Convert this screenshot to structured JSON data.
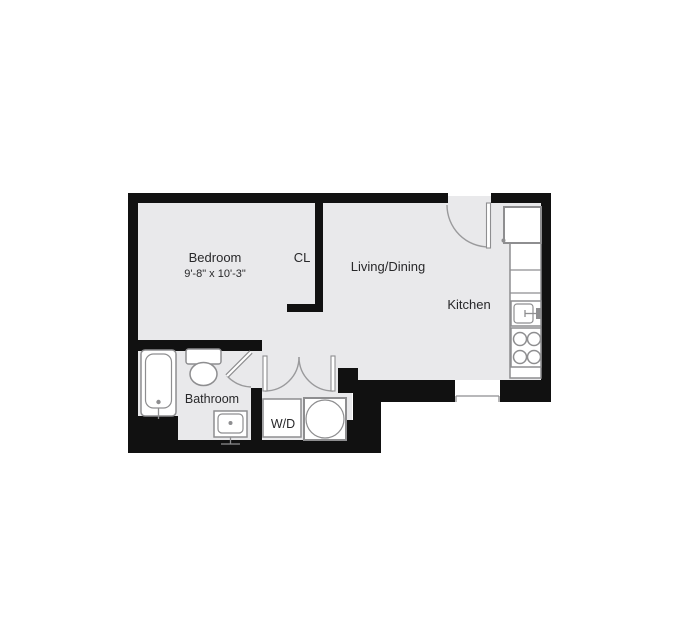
{
  "floor_plan": {
    "rooms": {
      "bedroom": {
        "label": "Bedroom",
        "dimensions": "9'-8\" x 10'-3\""
      },
      "closet": {
        "label": "CL"
      },
      "living_dining": {
        "label": "Living/Dining"
      },
      "kitchen": {
        "label": "Kitchen"
      },
      "bathroom": {
        "label": "Bathroom"
      },
      "laundry": {
        "label": "W/D"
      }
    },
    "fixtures": [
      "refrigerator-icon",
      "kitchen-counter-icon",
      "kitchen-sink-icon",
      "stove-icon",
      "bathtub-icon",
      "toilet-icon",
      "bathroom-sink-icon",
      "washer-dryer-icon",
      "entry-door-icon",
      "bathroom-door-icon",
      "closet-double-door-icon",
      "window-icon"
    ],
    "colors": {
      "wall": "#111111",
      "floor": "#e9e9eb",
      "fixture_stroke": "#8e8e90",
      "text": "#28282a",
      "background": "#ffffff"
    }
  }
}
